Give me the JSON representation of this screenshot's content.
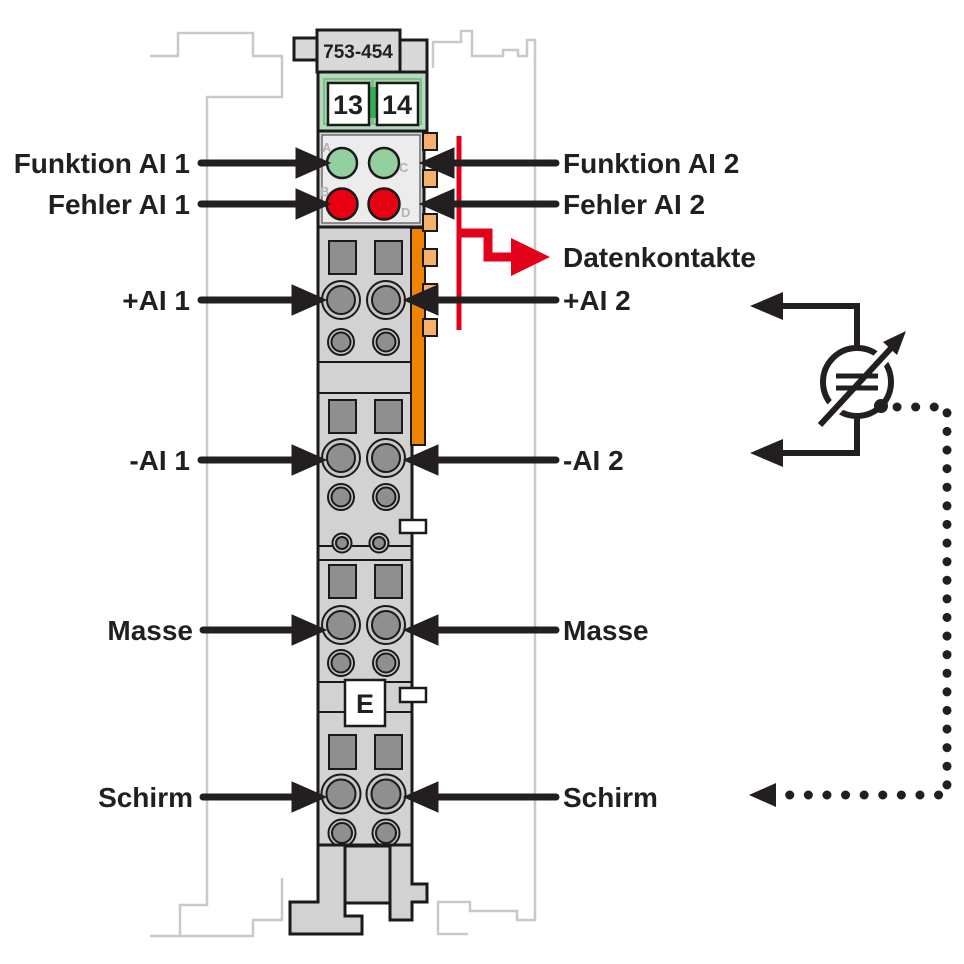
{
  "module": {
    "part_number": "753-454",
    "terminal_13": "13",
    "terminal_14": "14",
    "e_marker": "E",
    "led_letters": {
      "a": "A",
      "b": "B",
      "c": "C",
      "d": "D"
    }
  },
  "labels_left": {
    "funktion_ai1": "Funktion AI 1",
    "fehler_ai1": "Fehler AI 1",
    "plus_ai1": "+AI 1",
    "minus_ai1": "-AI 1",
    "masse": "Masse",
    "schirm": "Schirm"
  },
  "labels_right": {
    "funktion_ai2": "Funktion AI 2",
    "fehler_ai2": "Fehler AI 2",
    "datenkontakte": "Datenkontakte",
    "plus_ai2": "+AI 2",
    "minus_ai2": "-AI 2",
    "masse": "Masse",
    "schirm": "Schirm"
  },
  "colors": {
    "wago_red": "#e2001a",
    "led_green": "#94cf9f",
    "led_red": "#e60012",
    "orange_strip": "#ef8200",
    "orange_tab": "#f6b06c",
    "module_gray": "#d2d2d2",
    "contact_gray": "#8f8f8f",
    "green_block": "#b4dabb",
    "green_center": "#35ae52",
    "outline_black": "#1a1a1a",
    "ghost_gray": "#c9c9c9"
  }
}
